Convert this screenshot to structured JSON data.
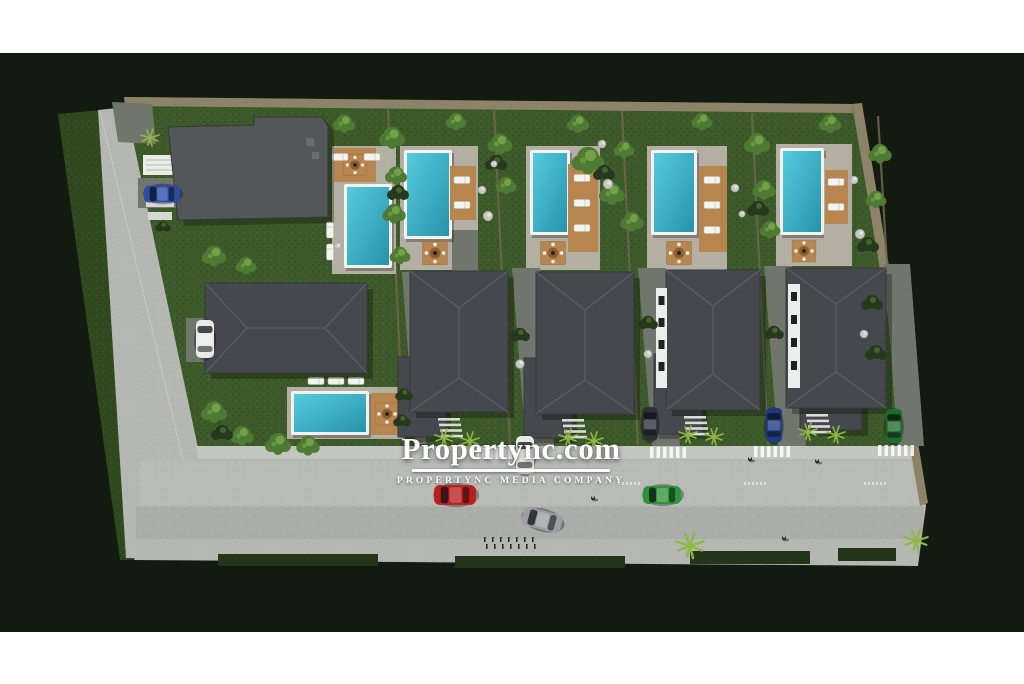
{
  "watermark": {
    "title": "Propertync.com",
    "subtitle": "PROPERTYNC MEDIA COMPANY"
  },
  "palette": {
    "page-bg": "#ffffff",
    "bg-dark": "#131a0f",
    "grass": "#3d5a2a",
    "grass-dark": "#31491f",
    "hedge": "#233619",
    "road": "#b4b7b2",
    "sidewalk": "#c3c5c0",
    "path": "#71766c",
    "patio": "#b3afa2",
    "wall": "#8d8368",
    "divider": "#6e6753",
    "roof-flat": "#54575a",
    "roof-hip": "#45494d",
    "roof-edge": "#35383b",
    "ridge": "#5d6165",
    "pool-light": "#55cbdd",
    "pool-dark": "#2793ab",
    "wood": "#b7854e",
    "wood-dark": "#8a5f33",
    "bush": "#26391c",
    "tree": "#4e7a33",
    "tree-light": "#7aa84e",
    "palm": "#8fb944",
    "stone": "#c6c8c3",
    "white": "#f2f3f1",
    "car-red": "#bb1f1c",
    "car-silver": "#9aa0a3",
    "car-green": "#2f9338",
    "car-blue": "#2b4da8",
    "car-navy": "#1d3a80",
    "car-white": "#e9eae7",
    "car-dark": "#2e3134",
    "car-truck-green": "#1f6b2c"
  }
}
